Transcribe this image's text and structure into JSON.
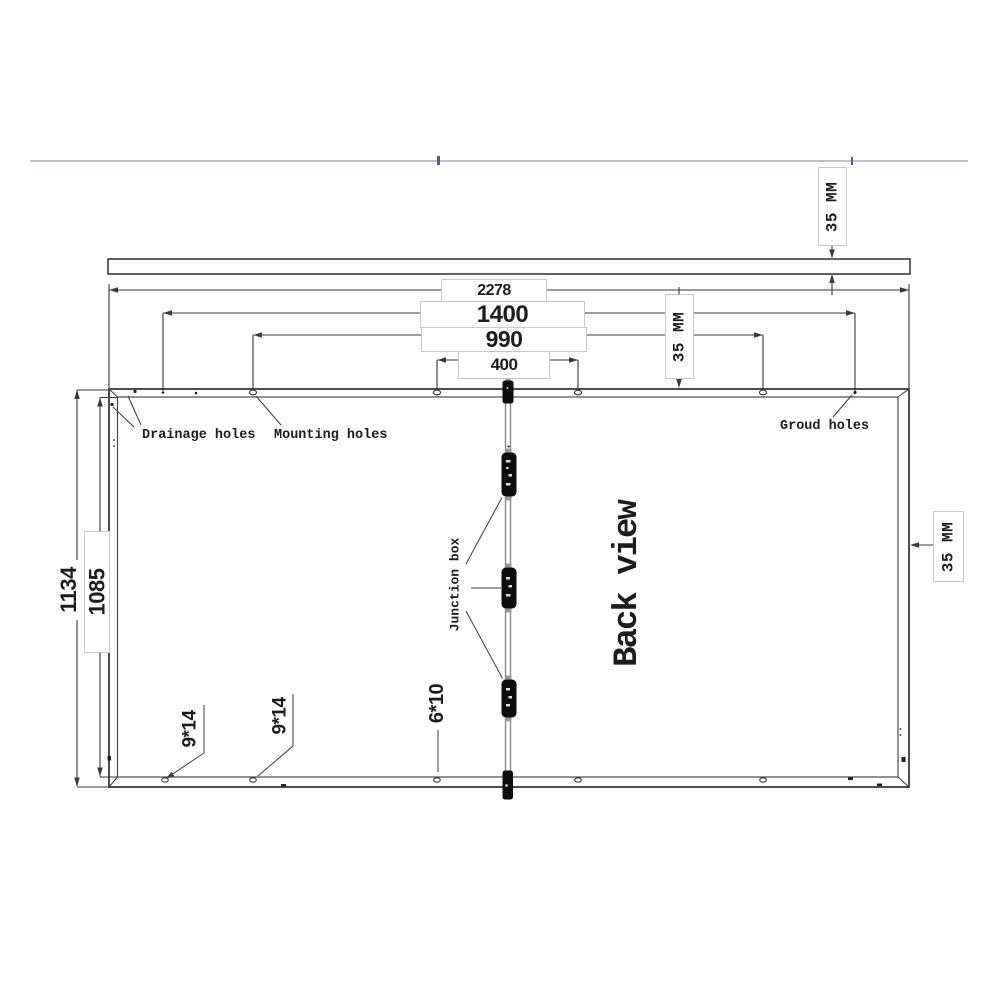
{
  "drawing": {
    "view_label": "Back view",
    "dim_width_total": "2278",
    "dim_mount_wide": "1400",
    "dim_mount_mid": "990",
    "dim_mount_narrow": "400",
    "dim_height_total": "1134",
    "dim_height_inner": "1085",
    "dim_thickness_top": "35 MM",
    "dim_edge_offset": "35 MM",
    "dim_frame_side": "35 MM",
    "label_drainage": "Drainage holes",
    "label_mounting": "Mounting holes",
    "label_ground": "Groud holes",
    "label_junction": "Junction box",
    "hole_spec_left": "9*14",
    "hole_spec_mid": "9*14",
    "hole_spec_bottom": "6*10",
    "colors": {
      "line": "#3a3a3a",
      "separator": "#b9c3ca",
      "label_border": "#c8c8c8",
      "cable": "#8a8a8a"
    }
  }
}
